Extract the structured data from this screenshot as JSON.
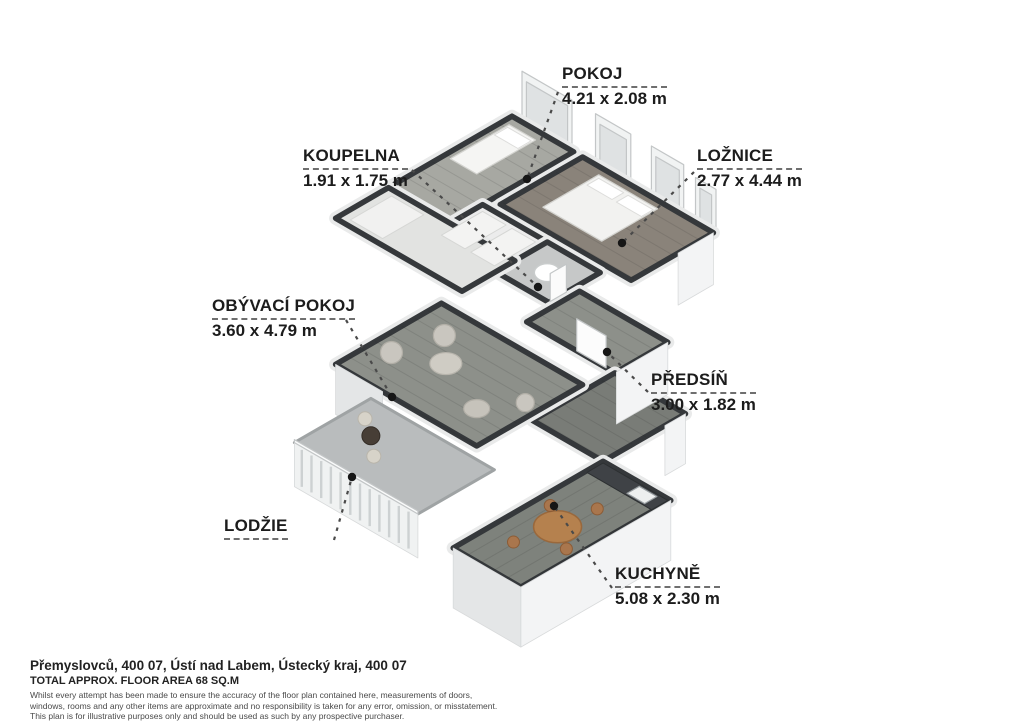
{
  "floorplan": {
    "rooms": [
      {
        "id": "pokoj",
        "name": "POKOJ",
        "dims": "4.21 x 2.08 m"
      },
      {
        "id": "koupelna",
        "name": "KOUPELNA",
        "dims": "1.91 x 1.75 m"
      },
      {
        "id": "loznice",
        "name": "LOŽNICE",
        "dims": "2.77 x 4.44 m"
      },
      {
        "id": "obyvaci",
        "name": "OBÝVACÍ POKOJ",
        "dims": "3.60 x 4.79 m"
      },
      {
        "id": "predsin",
        "name": "PŘEDSÍŇ",
        "dims": "3.00 x 1.82 m"
      },
      {
        "id": "lodzie",
        "name": "LODŽIE",
        "dims": ""
      },
      {
        "id": "kuchyne",
        "name": "KUCHYNĚ",
        "dims": "5.08 x 2.30 m"
      }
    ],
    "colors": {
      "background": "#ffffff",
      "wall_cap": "#35383b",
      "wall_outer": "#e9eaea",
      "facade": "#f3f4f5",
      "facade_shade": "#e4e6e7",
      "wood_floor": "#8d908a",
      "bedroom_floor": "#8a837a",
      "pokoj_floor": "#a7a8a2",
      "tile_floor": "#c6c8c8",
      "core_floor": "#e2e3e1",
      "loggia_floor": "#b9bcbd",
      "kitchen_table": "#b5814e",
      "counter": "#3f4246",
      "chair_gray": "#c9c6bf",
      "label_text": "#1c1c1c",
      "leader": "#4a4a4a",
      "dot": "#161616"
    }
  },
  "footer": {
    "address": "Přemyslovců, 400 07, Ústí nad Labem, Ústecký kraj, 400 07",
    "total_area": "TOTAL APPROX. FLOOR AREA 68 SQ.M",
    "disclaimer_lines": [
      "Whilst every attempt has been made to ensure the accuracy of the floor plan contained here, measurements of doors,",
      "windows, rooms and any other items are approximate and no responsibility is taken for any error, omission, or misstatement.",
      "This plan is for illustrative purposes only and should be used as such by any prospective purchaser."
    ]
  }
}
